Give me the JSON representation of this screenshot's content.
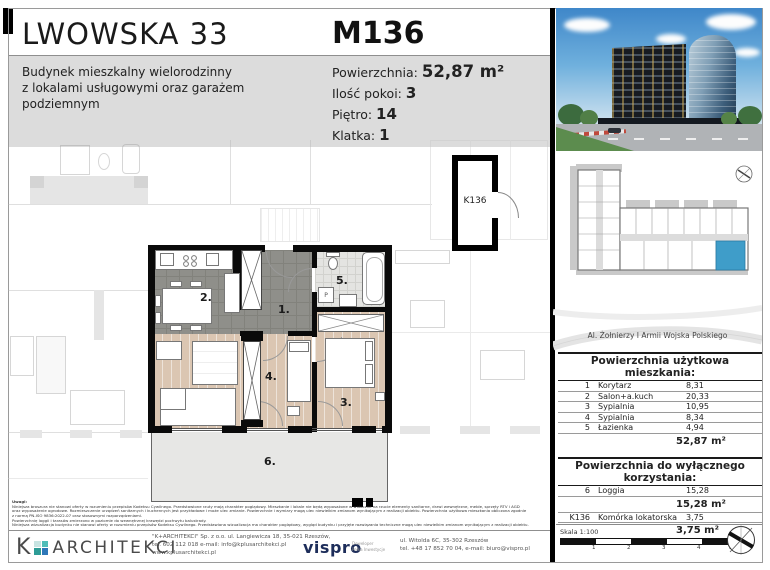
{
  "header": {
    "project_title": "LWOWSKA 33",
    "unit_id": "M136",
    "description_lines": [
      "Budynek mieszkalny wielorodzinny",
      "z lokalami usługowymi oraz garażem",
      "podziemnym"
    ],
    "details": [
      {
        "label": "Powierzchnia:",
        "value": "52,87 m²"
      },
      {
        "label": "Ilość pokoi:",
        "value": "3"
      },
      {
        "label": "Piętro:",
        "value": "14"
      },
      {
        "label": "Klatka:",
        "value": "1"
      }
    ]
  },
  "floor_plan": {
    "room_labels": {
      "r1": "1.",
      "r2": "2.",
      "r3": "3.",
      "r4": "4.",
      "r5": "5.",
      "r6": "6."
    },
    "storage_label": "K136",
    "washer_label": "P"
  },
  "right_panel": {
    "street_label": "Al. Żołnierzy I Armii Wojska Polskiego",
    "usable_area_table": {
      "title": "Powierzchnia użytkowa mieszkania:",
      "rows": [
        {
          "no": "1",
          "name": "Korytarz",
          "area": "8,31"
        },
        {
          "no": "2",
          "name": "Salon+a.kuch",
          "area": "20,33"
        },
        {
          "no": "3",
          "name": "Sypialnia",
          "area": "10,95"
        },
        {
          "no": "4",
          "name": "Sypialnia",
          "area": "8,34"
        },
        {
          "no": "5",
          "name": "Łazienka",
          "area": "4,94"
        }
      ],
      "total": "52,87 m²"
    },
    "exclusive_area_table": {
      "title": "Powierzchnia do wyłącznego korzystania:",
      "rows": [
        {
          "no": "6",
          "name": "Loggia",
          "area": "15,28",
          "subtotal": "15,28 m²"
        },
        {
          "no": "K136",
          "name": "Komórka lokatorska",
          "area": "3,75",
          "subtotal": "3,75 m²"
        }
      ]
    },
    "scale": {
      "label": "Skala 1:100",
      "ticks": [
        "1",
        "2",
        "3",
        "4",
        "5m"
      ]
    }
  },
  "footer": {
    "notes_title": "Uwagi:",
    "notes_lines": [
      "Niniejsza broszura nie stanowi oferty w rozumieniu przepisów Kodeksu Cywilnego. Przedstawione rzuty mają charakter poglądowy. Mieszkanie i lokale nie będą wyposażone w widoczne na rzucie elementy sanitarne, drzwi wewnętrzne, meble, sprzęty RTV i AGD",
      "oraz wyposażenie ogrodowe. Rozmieszczenie urządzeń sanitarnych i kuchennych jest przykładowe i może ulec zmianie. Powierzchnie i wymiary mogą ulec niewielkim zmianom wynikającym z realizacji obiektu. Powierzchnia użytkowa mieszkania obliczona zgodnie",
      "z normą PN-ISO 9836:2022-07 oraz stosownymi rozporządzeniami.",
      "Powierzchnię loggii i tarasów zmierzono w poziomie do wewnętrznej krawędzi pochwytu balustrady.",
      "Niniejsza wizualizacja budynku nie stanowi oferty w rozumieniu przepisów Kodeksu Cywilnego. Przedstawiona wizualizacja ma charakter poglądowy, wygląd budynku i przyjęte rozwiązania techniczne mogą ulec niewielkim zmianom wynikającym z realizacji obiektu."
    ],
    "architect": {
      "logo_k": "K",
      "logo_text": "ARCHITEKCI",
      "line1": "\"K+ARCHITEKCI\" Sp. z o.o. ul. Langiewicza 18, 35-021 Rzeszów,",
      "line2": "tel. 602 112 018 e-mail: info@kplusarchitekci.pl",
      "line3": "www.kplusarchitekci.pl"
    },
    "developer": {
      "logo": "vispro",
      "tag_line1": "Deweloper",
      "tag_line2": "Pełka Inwestycje",
      "line1": "ul. Witolda 6C, 35-302 Rzeszów",
      "line2": "tel. +48 17 852 70 04, e-mail: biuro@vispro.pl"
    }
  },
  "colors": {
    "header_band_gray": "#dcdcdc",
    "highlight_blue": "#3f9dc9",
    "dark_floor": "#8f8f8a",
    "wood_floor": "#dbc6b2",
    "logo_teal": "#3aaea8",
    "logo_blue": "#2e77b8",
    "vispro_navy": "#1d2d5a"
  }
}
